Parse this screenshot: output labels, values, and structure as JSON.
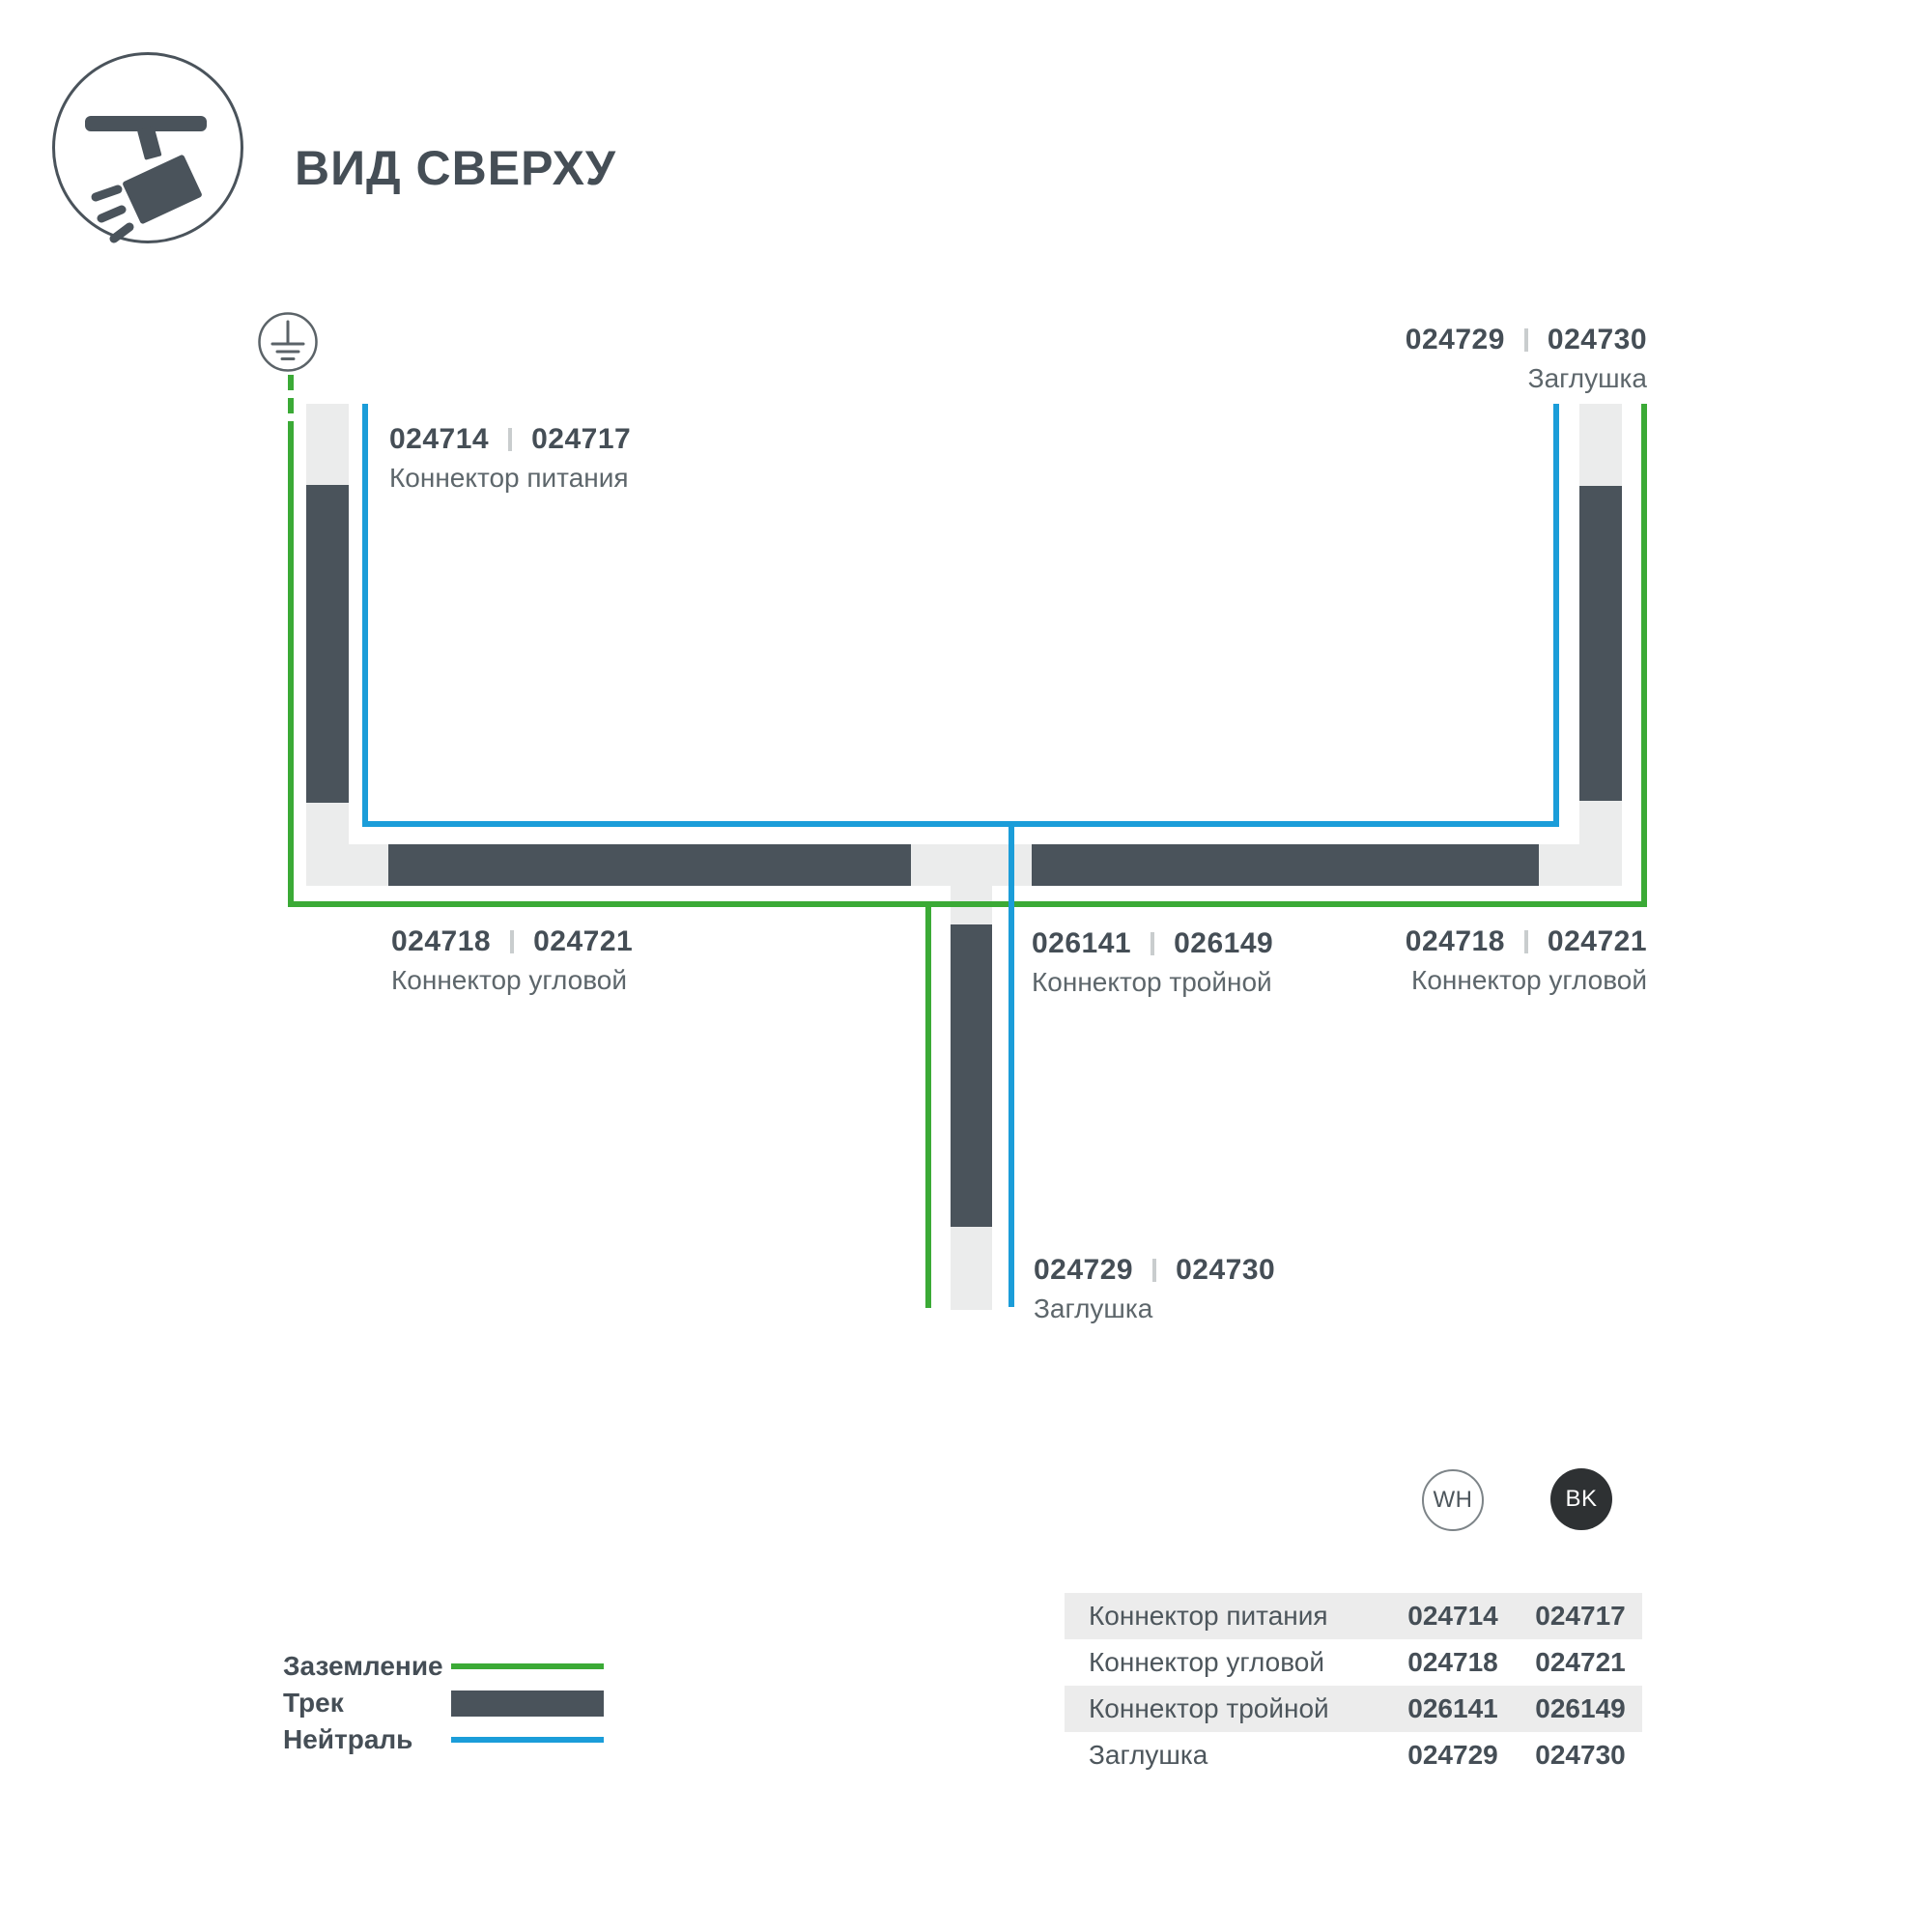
{
  "header": {
    "title": "ВИД СВЕРХУ"
  },
  "diagram": {
    "power": {
      "code_wh": "024714",
      "code_bk": "024717",
      "name": "Коннектор питания"
    },
    "endcap_top": {
      "code_wh": "024729",
      "code_bk": "024730",
      "name": "Заглушка"
    },
    "corner_left": {
      "code_wh": "024718",
      "code_bk": "024721",
      "name": "Коннектор угловой"
    },
    "tee": {
      "code_wh": "026141",
      "code_bk": "026149",
      "name": "Коннектор тройной"
    },
    "corner_right": {
      "code_wh": "024718",
      "code_bk": "024721",
      "name": "Коннектор угловой"
    },
    "endcap_bottom": {
      "code_wh": "024729",
      "code_bk": "024730",
      "name": "Заглушка"
    }
  },
  "legend": {
    "ground": {
      "label": "Заземление"
    },
    "track": {
      "label": "Трек"
    },
    "neutral": {
      "label": "Нейтраль"
    }
  },
  "variants": {
    "white": "WH",
    "black": "BK"
  },
  "table": {
    "rows": [
      {
        "label": "Коннектор питания",
        "wh": "024714",
        "bk": "024717"
      },
      {
        "label": "Коннектор угловой",
        "wh": "024718",
        "bk": "024721"
      },
      {
        "label": "Коннектор тройной",
        "wh": "026141",
        "bk": "026149"
      },
      {
        "label": "Заглушка",
        "wh": "024729",
        "bk": "024730"
      }
    ]
  },
  "colors": {
    "ground_green": "#3BAA36",
    "neutral_blue": "#1B9DD9",
    "track_dark": "#4A535B",
    "track_light": "#EBECEC"
  }
}
